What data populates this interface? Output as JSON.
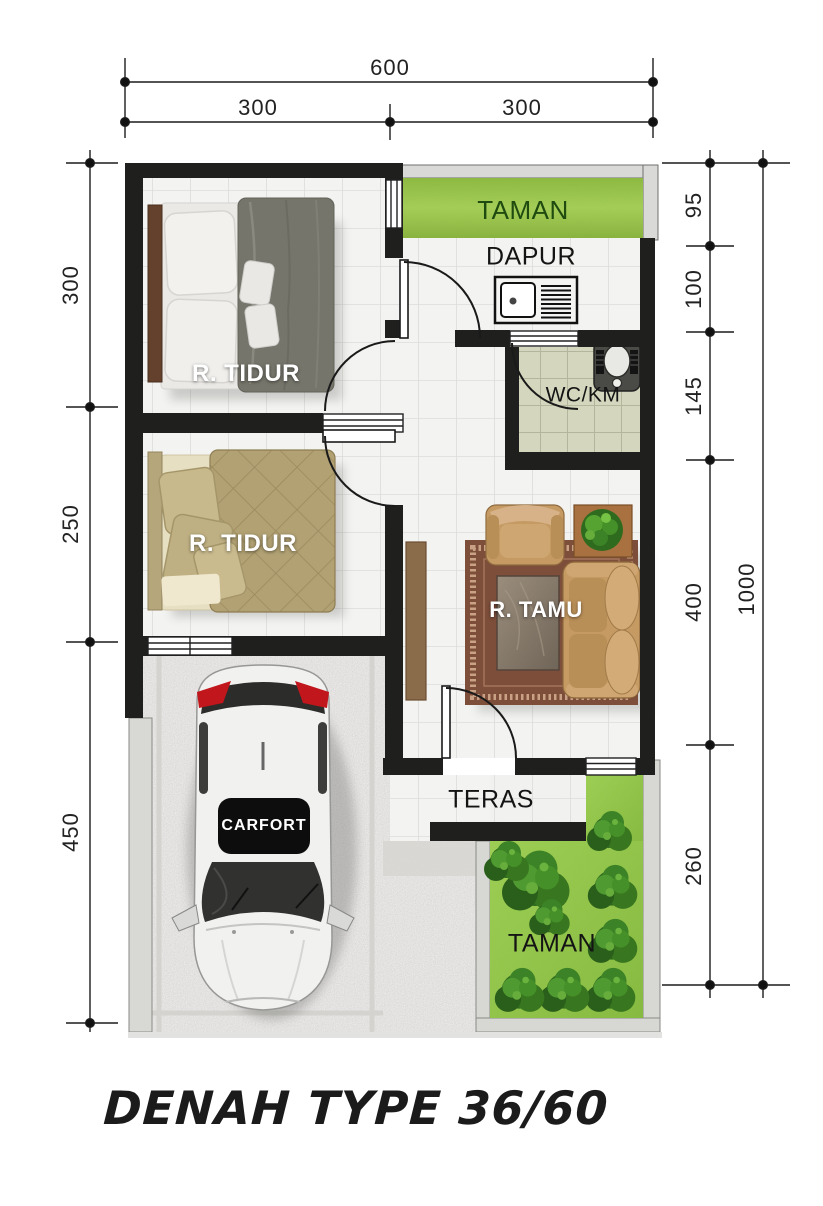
{
  "title": {
    "text": "DENAH TYPE 36/60"
  },
  "rooms": {
    "bedroom1": "R. TIDUR",
    "bedroom2": "R. TIDUR",
    "garden_top": "TAMAN",
    "kitchen": "DAPUR",
    "bathroom": "WC/KM",
    "living_room": "R. TAMU",
    "terrace": "TERAS",
    "garden_bottom": "TAMAN",
    "carport": "CARFORT"
  },
  "dimensions": {
    "top": {
      "total": "600",
      "left": "300",
      "right": "300"
    },
    "left": {
      "upper": "300",
      "middle": "250",
      "lower": "450"
    },
    "right": {
      "d1": "95",
      "d2": "100",
      "d3": "145",
      "d4": "400",
      "d5": "260",
      "total": "1000"
    }
  },
  "colors": {
    "wall": "#1f1f1d",
    "grass": "#8cc43e",
    "wc_tile": "#d4d7bd",
    "floor_tile": "#f3f3f1",
    "rug": "#7d4e3a",
    "sofa": "#c59a63",
    "carport_floor": "#b2b1ae"
  }
}
